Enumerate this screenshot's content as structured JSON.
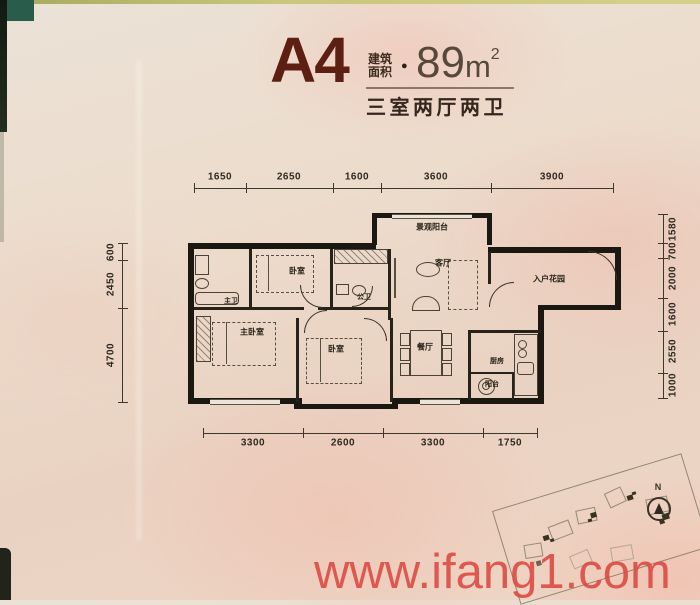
{
  "header": {
    "plan_code": "A4",
    "area_label_top": "建筑",
    "area_label_bottom": "面积",
    "bullet": "●",
    "area_value": "89",
    "area_unit": "m",
    "area_sup": "2",
    "subtitle": "三室两厅两卫"
  },
  "dims": {
    "top": [
      "1650",
      "2650",
      "1600",
      "3600",
      "3900"
    ],
    "bottom": [
      "3300",
      "2600",
      "3300",
      "1750"
    ],
    "left": [
      "600",
      "2450",
      "4700"
    ],
    "right": [
      "1580",
      "700",
      "2000",
      "1600",
      "2550",
      "1000"
    ]
  },
  "rooms": {
    "view_balcony": "景观阳台",
    "living": "客厅",
    "entry_garden": "入户花园",
    "master_bath": "主卫",
    "bedroom_top": "卧室",
    "public_bath": "公卫",
    "master_bedroom": "主卧室",
    "bedroom_mid": "卧室",
    "dining": "餐厅",
    "kitchen": "厨房",
    "balcony": "阳台"
  },
  "compass": {
    "north_label": "N"
  },
  "watermark": {
    "text": "www.ifang1.com"
  },
  "colors": {
    "title_maroon": "#5c1f12",
    "watermark_red": "#dc4840",
    "paper": "#ead9c9",
    "plan_line": "#1b1812"
  }
}
